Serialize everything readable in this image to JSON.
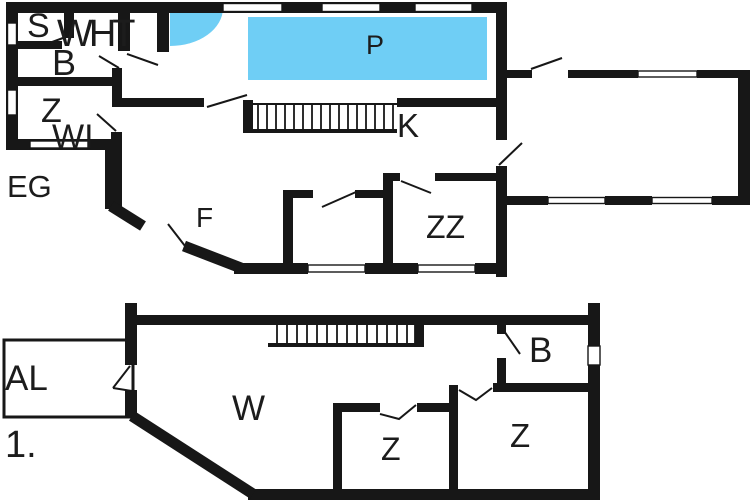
{
  "document": {
    "type": "floor-plan",
    "levels": 2
  },
  "colors": {
    "wall": "#171717",
    "pool": "#6fcef5",
    "label": "#1c1c1c",
    "background": "#ffffff"
  },
  "floors": [
    {
      "id": "ground",
      "floor_label": "EG",
      "rooms": {
        "s": "S",
        "wht": "WHT",
        "b": "B",
        "z": "Z",
        "wi": "WI",
        "pool": "P",
        "stairs": "K",
        "f": "F",
        "zz": "ZZ"
      }
    },
    {
      "id": "first",
      "floor_label": "1.",
      "rooms": {
        "al": "AL",
        "w": "W",
        "b": "B",
        "z_mid": "Z",
        "z_right": "Z"
      }
    }
  ]
}
